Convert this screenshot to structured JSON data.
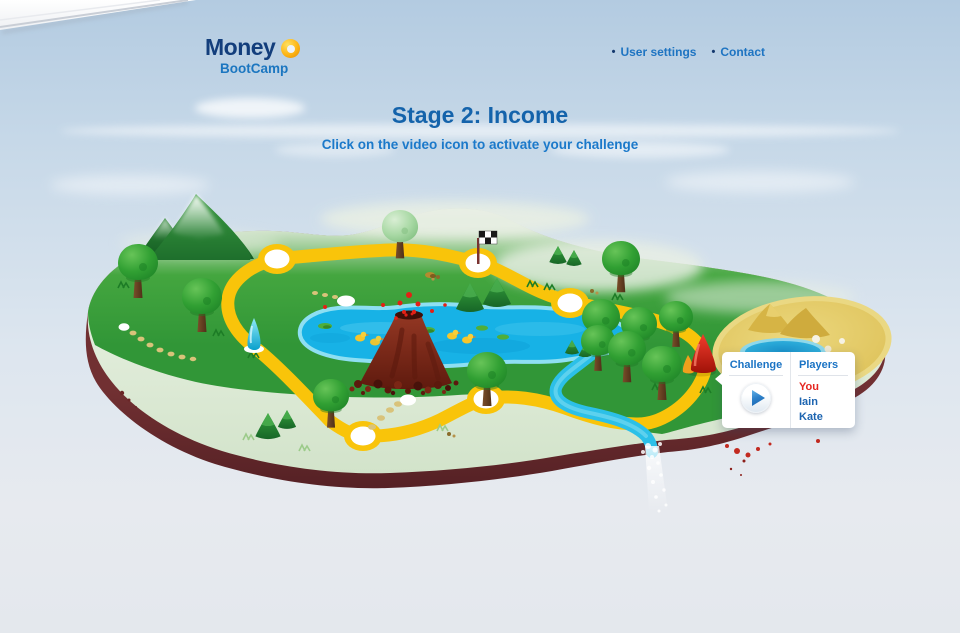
{
  "logo": {
    "line1": "Money",
    "line2": "BootCamp"
  },
  "nav": [
    {
      "bullet": "•",
      "label": "User settings"
    },
    {
      "bullet": "•",
      "label": "Contact"
    }
  ],
  "stage": {
    "title": "Stage 2: Income",
    "subtitle": "Click on the video icon to activate your challenge"
  },
  "popup": {
    "challenge_label": "Challenge",
    "players_label": "Players",
    "players": [
      {
        "name": "You"
      },
      {
        "name": "Iain"
      },
      {
        "name": "Kate"
      }
    ]
  },
  "icons": {
    "logo-donut-icon": "gold ring",
    "play-icon": "blue right-pointing triangle",
    "finish-flag-icon": "checkered flag",
    "challenge-flame-marker-icon": "red cone flame",
    "checkpoint-marker-icon": "cyan spike"
  },
  "colors": {
    "heading_blue": "#1463ab",
    "link_blue": "#1b76c0",
    "logo_navy": "#133e7c",
    "player_you_red": "#e52620",
    "player_blue": "#1c64b0",
    "path_yellow": "#f9c40a",
    "island_green": "#39a23a",
    "island_soil": "#5c2327",
    "lake_cyan": "#17b2e6",
    "sand_yellow": "#e0c55f"
  }
}
